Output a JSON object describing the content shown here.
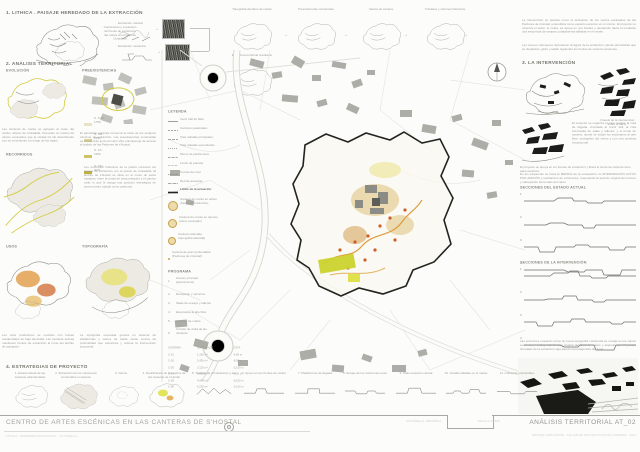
{
  "section1": {
    "title": "1. LITHICA . PAISAJE HEREDADO DE LA EXTRACCIÓN",
    "note": "Crecimiento y expansión del frente de extracción del marés en el llano de Ciutadella",
    "label_manual": "Extracción manual",
    "label_mecanica": "Extracción mecánica",
    "arrow": "→"
  },
  "topband": {
    "arrow": "→",
    "items": [
      {
        "caption": "Topografía del llano de marés"
      },
      {
        "caption": "Preexistencias construidas"
      },
      {
        "caption": "Vacíos de cantera"
      },
      {
        "caption": "Trazados y caminos históricos"
      },
      {
        "caption": "Estructura territorial resultante"
      }
    ]
  },
  "section2": {
    "title": "2. ANÁLISIS TERRITORIAL",
    "sub1": "EVOLUCIÓN",
    "sub2": "PREEXISTENCIAS",
    "sub3": "RECORRIDOS",
    "sub4": "USOS",
    "sub5": "TOPOGRAFÍA",
    "eras": [
      {
        "sw": "#e8e3c8",
        "label": "S. XVIII · 1750"
      },
      {
        "sw": "#dcd49a",
        "label": "S. XIX · 1850"
      },
      {
        "sw": "#cfc36a",
        "label": "S. XX · 1950"
      },
      {
        "sw": "#bfb13d",
        "label": "S. XXI · 2021"
      }
    ],
    "paraA1": "Las canteras de marés se agrupan al oeste del núcleo urbano de Ciutadella, formando un rosario de vacíos excavados que la ciudad ha ido absorbiendo con su crecimiento a lo largo de los siglos.",
    "paraA2": "El parcelario agrícola conserva la traza de los antiguos caminos de extracción. Las preexistencias construidas se concentran junto al Camí Vell, principal eje de acceso al ámbito de las Pedreres de s'Hostal.",
    "paraB": "Los recorridos históricos de la piedra conectan los frentes de extracción con el puerto de Ciutadella. El ámbito de s'Hostal se sitúa en el cruce de estos trazados, entre la ronda de circunvalación y el camino rural, lo que le otorga una posición estratégica de acceso tanto rodado como peatonal.",
    "paraC1": "Los usos productivos se mezclan con bolsas residenciales de baja densidad. Las canteras activas mantienen frentes de extracción al norte del ámbito de actuación.",
    "paraC2": "La topografía excavada genera un sistema de plataformas y vacíos de hasta veinte metros de profundidad que estructura y ordena la intervención propuesta."
  },
  "legend": {
    "title": "LEYENDA",
    "limit": "Límite de la actuación",
    "lines": [
      {
        "dash": "0",
        "label": "Camí Vell de Maó"
      },
      {
        "dash": "2 1",
        "label": "Caminos peatonales"
      },
      {
        "dash": "3 1",
        "label": "Vías rodadas principales"
      },
      {
        "dash": "1 1",
        "label": "Vías rodadas secundarias"
      },
      {
        "dash": "2 .6 .6 .6",
        "label": "Muros de piedra seca"
      },
      {
        "dash": ".6 .8",
        "label": "Límite de parcela"
      },
      {
        "dash": "1 .6",
        "label": "Curvas de nivel"
      },
      {
        "dash": "3 .6 1 .6",
        "label": "Red de acequias"
      }
    ],
    "quarries": [
      {
        "label": "Cantera de marés en activo (frente de extracción)"
      },
      {
        "label": "Cantera de marés en desuso (vacío excavado)"
      },
      {
        "label": "Cantera rellenada (topografía alterada)"
      },
      {
        "label": "Cantera de gran profundidad (Pedreres de s'Hostal)"
      }
    ],
    "program_title": "PROGRAMA",
    "program": [
      {
        "n": "1.",
        "label": "Acceso principal · aparcamiento"
      },
      {
        "n": "2.",
        "label": "Recepción y servicios"
      },
      {
        "n": "3.",
        "label": "Salas de ensayo y talleres"
      },
      {
        "n": "4.",
        "label": "Escenarios al aire libre"
      },
      {
        "n": "5.",
        "label": "Jardines de marés"
      },
      {
        "n": "6.",
        "label": "Circuito de visita de las canteras"
      }
    ],
    "table": {
      "headers": [
        "CANTERA",
        "SUPERFICIE",
        "COTA"
      ],
      "rows": [
        [
          "C-01",
          "1.250 m²",
          "-4,00 m"
        ],
        [
          "C-02",
          "2.430 m²",
          "-8,50 m"
        ],
        [
          "C-03",
          "3.120 m²",
          "-12,00 m"
        ],
        [
          "C-04",
          "1.860 m²",
          "-9,00 m"
        ],
        [
          "C-05",
          "4.540 m²",
          "-16,50 m"
        ],
        [
          "C-06",
          "6.230 m²",
          "-21,00 m"
        ]
      ]
    }
  },
  "section3": {
    "title": "3. LA INTERVENCIÓN",
    "para1": "La intervención se plantea como la activación de los vacíos excavados de las Pedreres de s'Hostal, entendidos como espacio escénico en sí mismo. El proyecto no coloniza el vacío: lo rodea, se apoya en sus bordes y desciende hacia él mediante una secuencia de rampas y plataformas talladas en el marés.",
    "para2": "Los nuevos volúmenes reproducen la lógica de la extracción: piezas prismáticas que se desplazan, giran y apilan siguiendo los frentes de cantera existentes.",
    "para3": "El conjunto se organiza en tres niveles: la cota de llegada, vinculada al Camí Vell; la cota intermedia de salas y talleres; y el fondo de cantera, donde se sitúan los escenarios al aire libre, protegidos del viento y con una acústica excepcional.",
    "caption1": "Croquis de la intervención sobre el vacío",
    "caption2": "El proyecto se apoya en los frentes de extracción y libera el fondo de cantera como patio escénico",
    "para4": "En los esquemas se traza la MEDIDA de la excavación: la INTERVENCIÓN ACTÚA POR ADICIÓN y sustracción de volúmenes, respetando la sección original del terreno y subrayando los bordes del vacío.",
    "headerA": "SECCIONES DEL ESTADO ACTUAL",
    "headerB": "SECCIONES DE LA INTERVENCIÓN",
    "sectionsA": [
      {
        "num": "1",
        "points": "0,8 30,8 34,5 48,5 50,8 62,8 64,10 78,10 80,8 112,8"
      },
      {
        "num": "2",
        "points": "0,9 22,9 26,7 40,7 44,9 58,9 60,12 70,12 72,9 112,9"
      },
      {
        "num": "3",
        "points": "0,8 14,8 16,13 30,13 32,8 50,8 52,6 64,6 66,8 84,8 86,11 100,11 102,8 112,8"
      },
      {
        "num": "4",
        "points": "0,8 40,8 44,10 60,10 62,8 78,8 80,13 96,13 98,8 112,8"
      }
    ],
    "sectionsB": [
      {
        "num": "1",
        "points": "0,8 26,8 30,5 44,5 46,3 54,3 56,8 66,8 68,10 82,10 84,8 112,8"
      },
      {
        "num": "2",
        "points": "0,9 20,9 24,8 38,8 40,5 52,5 54,9 68,9 70,11 80,11 82,9 112,9"
      },
      {
        "num": "3",
        "points": "0,8 12,8 14,12 28,12 30,8 46,8 48,5 60,5 62,8 86,8 88,10 98,10 100,8 112,8"
      },
      {
        "num": "4",
        "points": "0,8 36,8 40,10 54,10 56,8 70,8 72,13 90,13 92,8 112,8"
      }
    ],
    "para5": "Las secciones muestran cómo la nueva topografía construida se encaja en los vacíos existentes, restituyendo la cota original del llano de marés y dejando que el paisaje heredado de la extracción siga siendo el protagonista del lugar."
  },
  "section4": {
    "title": "4. ESTRATEGIAS DE PROYECTO",
    "steps": [
      {
        "caption": "1. Estado actual de las canteras abandonadas"
      },
      {
        "caption": "2. Extracción de los volúmenes construidos en desuso"
      },
      {
        "caption": "3. Vacíos"
      },
      {
        "caption": "4. Reutilización de los vacíos de las canteras de s'Hostal"
      }
    ],
    "icons": [
      {
        "caption": "5. Trazado de circulaciones y accesos",
        "points": "4,13 12,5 20,12 28,4 36,12 44,6 52,12"
      },
      {
        "caption": "6. Apoyo en los frentes de cantera",
        "points": "0,11 16,11 18,5 30,5 32,11 56,11"
      },
      {
        "caption": "7. Plataformas de llegada",
        "points": "0,11 18,11 18,5 34,5 34,11 56,11"
      },
      {
        "caption": "8. Encaje de los volúmenes escénicos",
        "points": "0,8 14,8 16,12 30,12 32,8 42,8 44,11 56,11"
      },
      {
        "caption": "9. Patio escénico central",
        "points": "0,11 16,11 18,4 34,4 36,11 56,11"
      },
      {
        "caption": "10. Gradas talladas en el marés",
        "points": "0,11 10,11 12,8 20,8 22,11 32,11 34,6 46,6 48,11 56,11"
      },
      {
        "caption": "11. Cubiertas practicables",
        "points": "0,9 18,9 20,12 38,12 40,9 56,9"
      }
    ]
  },
  "titleblock": {
    "title": "CENTRO DE ARTES ESCÉNICAS EN LAS CANTERAS DE  S'HOSTAL",
    "author": "LÍTHICA · PEDRERES DE S'HOSTAL · CIUTADELLA",
    "location": "CIUTADELLA, MENORCA",
    "scale": "ESCALA 1/2500",
    "sheet": "ANÁLISIS TERRITORIAL AT_02",
    "footnote": "MÁSTER HABILITANTE · TALLER DE PROYECTO FIN DE CARRERA · 2021"
  }
}
